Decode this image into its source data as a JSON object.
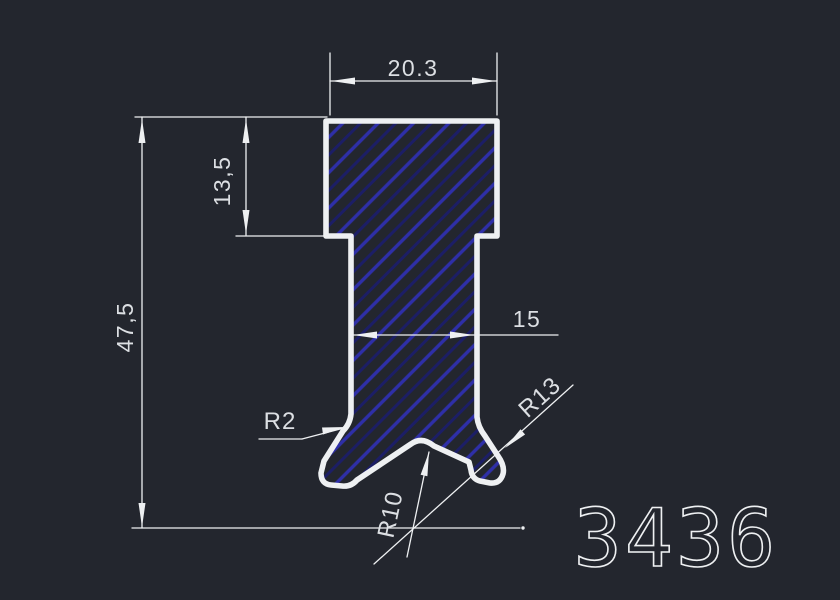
{
  "drawing": {
    "profile_number": "3436",
    "dimensions": {
      "top_width": "20.3",
      "upper_height": "13,5",
      "total_height": "47,5",
      "stem_width": "15",
      "fillet_radius": "R2",
      "side_radius": "R13",
      "groove_radius": "R10"
    },
    "colors": {
      "background": "#23262e",
      "line": "#eef0f2",
      "dim_text": "#dcdfe3",
      "hatch_bright": "#2e2fa8",
      "hatch_dark": "#1c1e66"
    }
  }
}
